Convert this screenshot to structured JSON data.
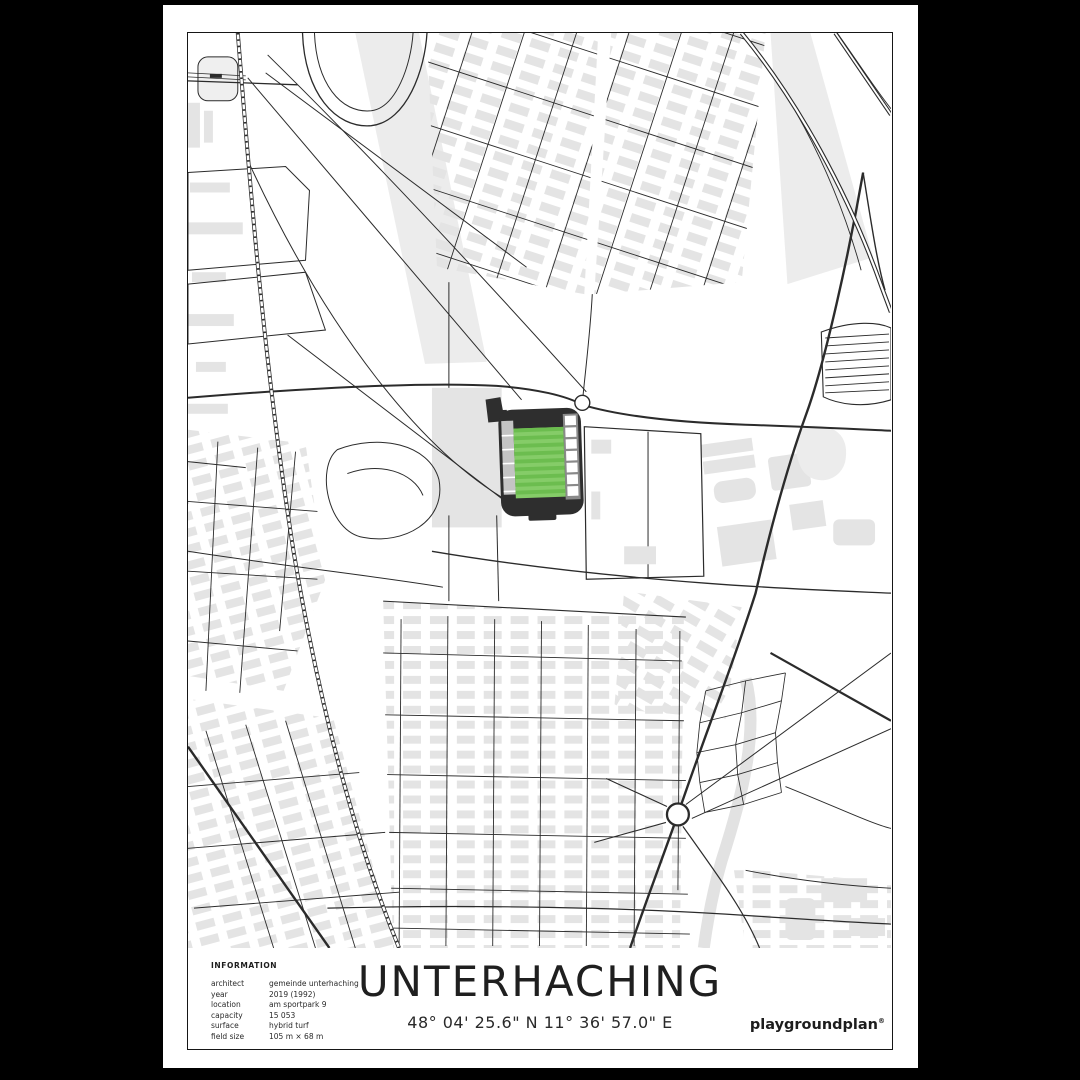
{
  "poster": {
    "title": "UNTERHACHING",
    "coordinates": "48° 04' 25.6\" N 11° 36' 57.0\" E",
    "brand": "playgroundplan",
    "brand_mark": "®"
  },
  "information": {
    "heading": "INFORMATION",
    "rows": [
      {
        "label": "architect",
        "value": "gemeinde unterhaching"
      },
      {
        "label": "year",
        "value": "2019 (1992)"
      },
      {
        "label": "location",
        "value": "am sportpark 9"
      },
      {
        "label": "capacity",
        "value": "15 053"
      },
      {
        "label": "surface",
        "value": "hybrid turf"
      },
      {
        "label": "field size",
        "value": "105 m × 68 m"
      }
    ]
  },
  "map": {
    "colors": {
      "building": "#e4e4e4",
      "building_light": "#ececec",
      "road": "#2b2b2b",
      "pitch_green_dark": "#6cbd4f",
      "pitch_green_light": "#85cc68",
      "stand_dark": "#2e2e2e",
      "stand_gray": "#c4c4c4",
      "stream": "#e2e2e2",
      "paper": "#ffffff"
    }
  }
}
